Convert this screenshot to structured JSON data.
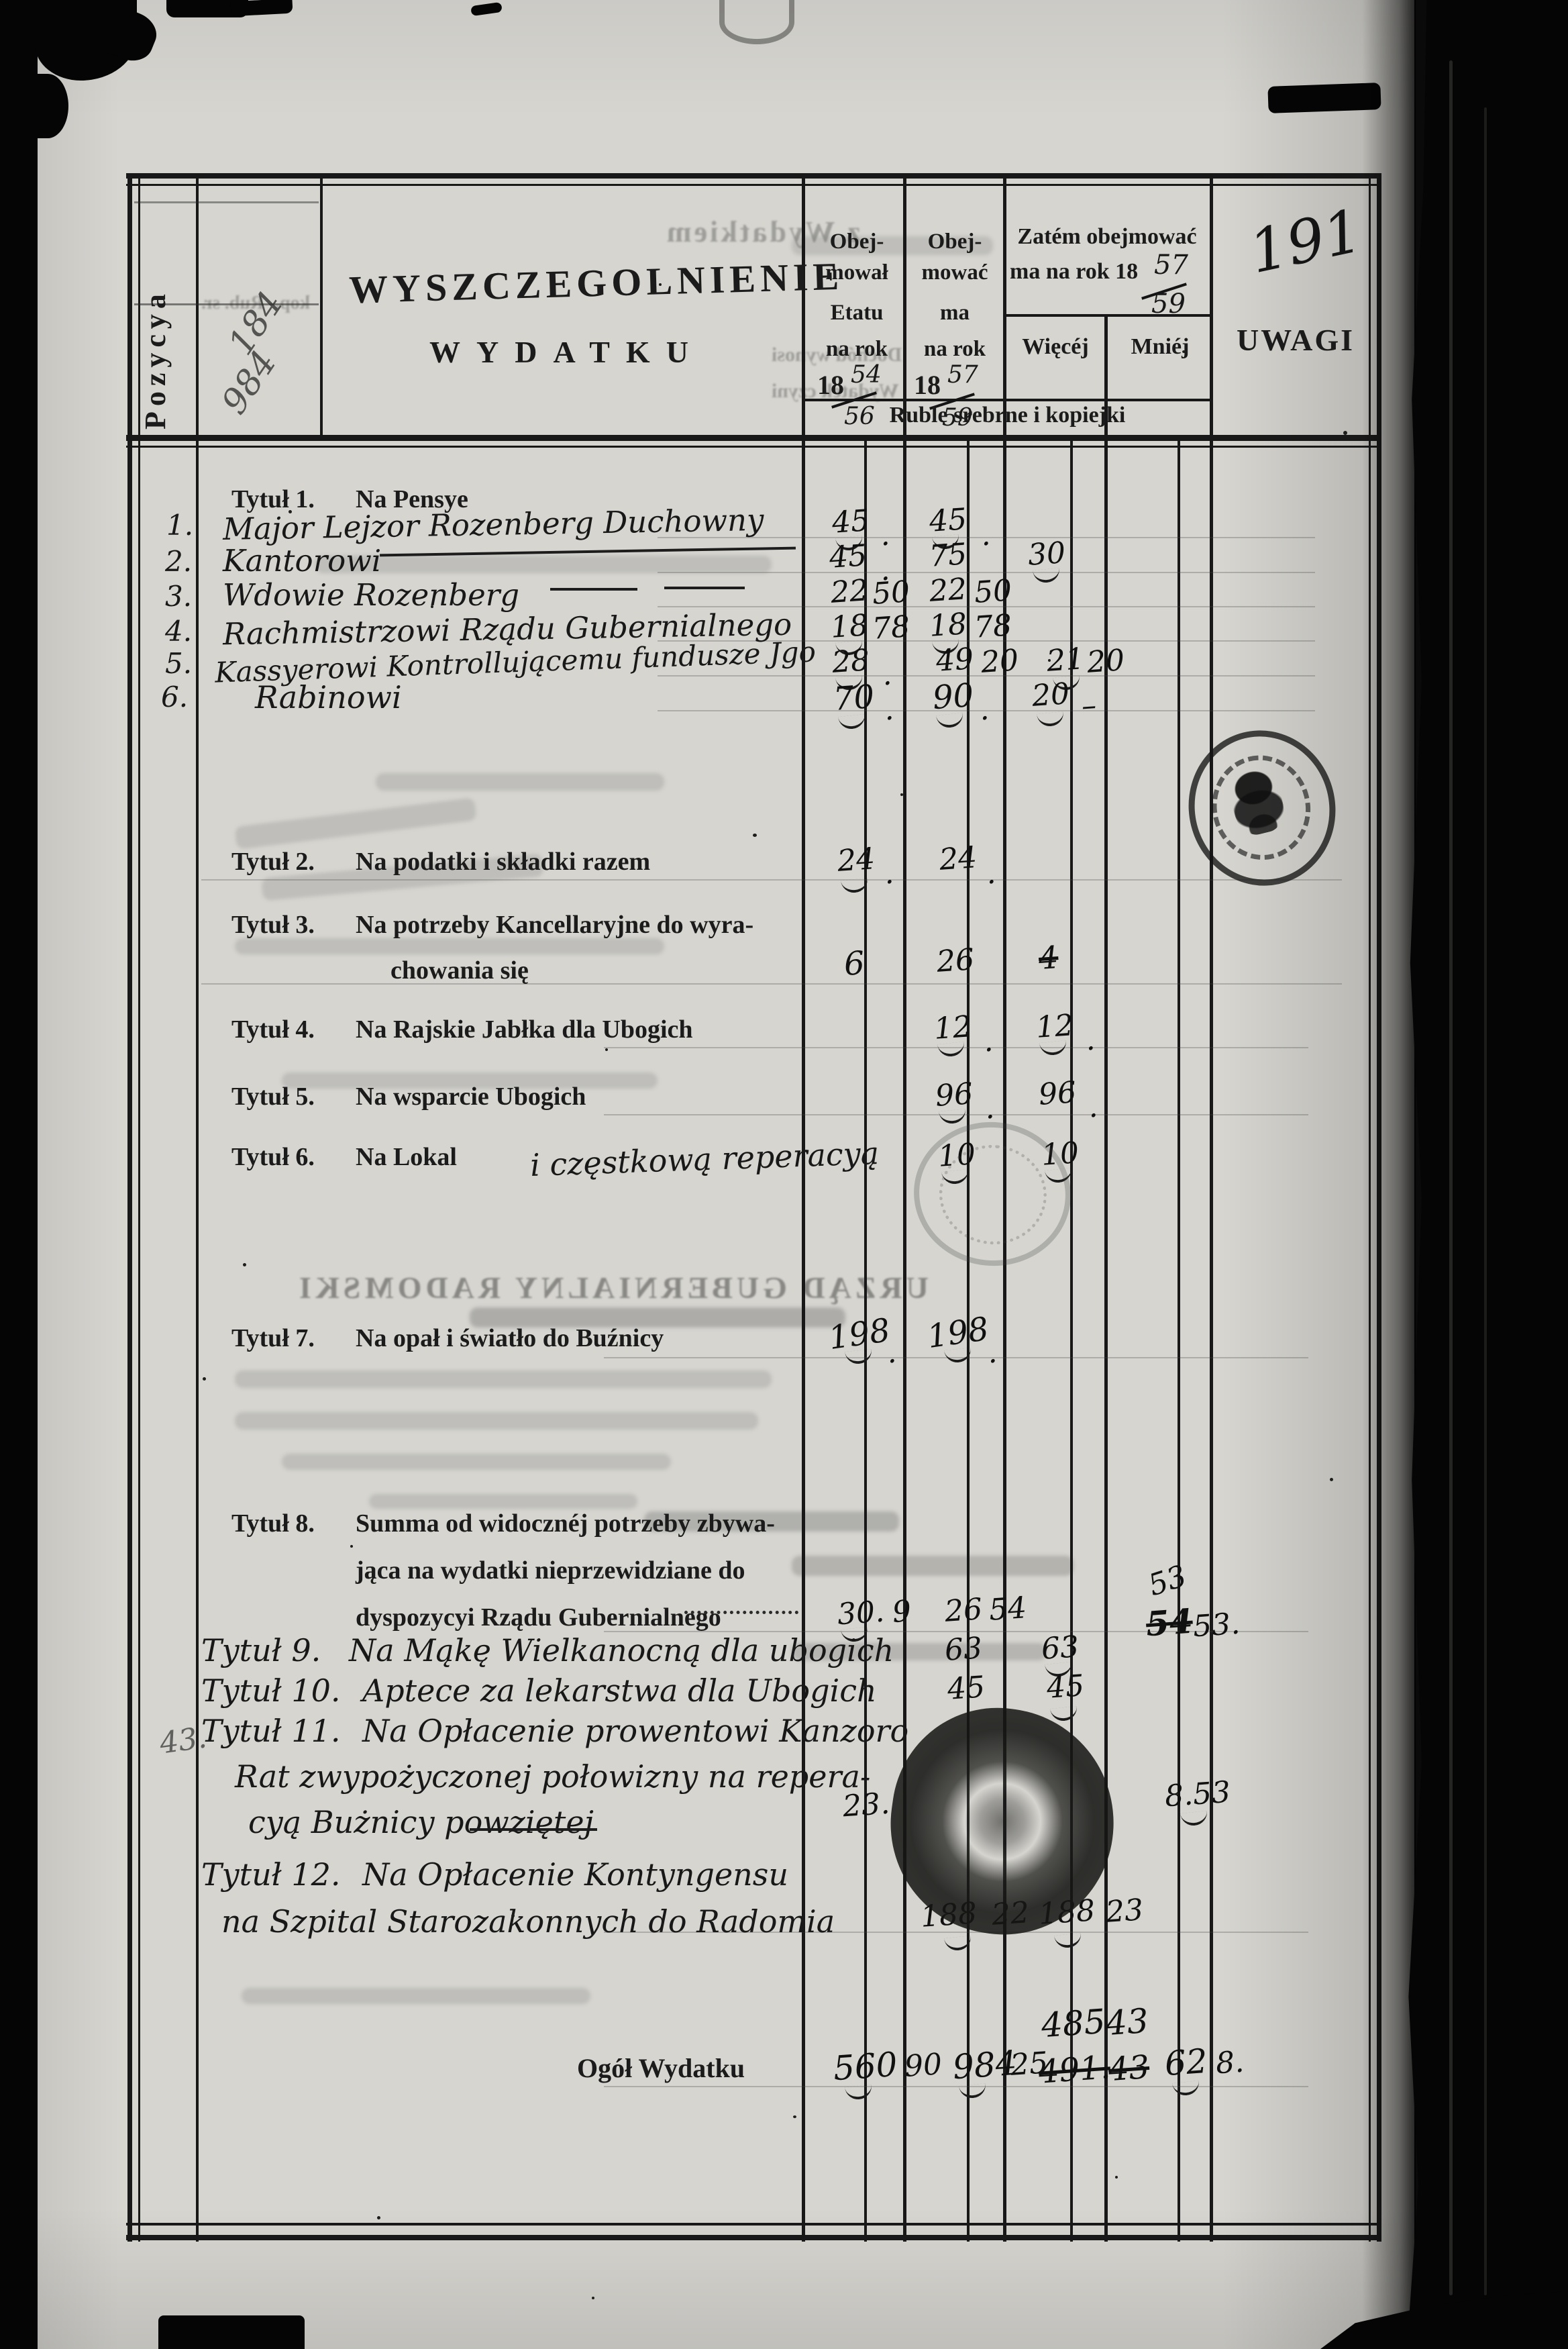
{
  "page": {
    "number": "191"
  },
  "header": {
    "pozycya": "Pozycya",
    "title_line1": "WYSZCZEGOLNIENIE",
    "title_line2": "WYDATKU",
    "col_etat": {
      "l1": "Obej-",
      "l2": "mował",
      "l3": "Etatu",
      "l4": "na rok",
      "year": "18",
      "f_top": "54",
      "f_bot": "56"
    },
    "col_ma": {
      "l1": "Obej-",
      "l2": "mować",
      "l3": "ma",
      "l4": "na rok",
      "year": "18",
      "f_top": "57",
      "f_bot": "59"
    },
    "col_zatem": {
      "l1": "Zatém obejmować",
      "l2": "ma na rok 18",
      "f_top": "57",
      "f_bot": "59",
      "wiecej": "Więcéj",
      "mniej": "Mniéj"
    },
    "uwagi": "UWAGI",
    "band": "Ruble srebrne i kopiejki"
  },
  "bleed": {
    "top": "z Wydatkiem",
    "dochod": "Dochód wynosi",
    "wydatek": "Wydatek czyni",
    "rub": "Rub. sr.",
    "kop": "kop.",
    "m1": "184",
    "m2": "984",
    "m3": "43.",
    "urzad": "URZĄD GUBERNIALNY RADOMSKI"
  },
  "body": {
    "t1_heading": "Tytuł 1.",
    "t1_text": "Na Pensye",
    "rows": [
      {
        "no": "1.",
        "label": "Major Lejzor Rozenberg Duchowny",
        "c1r": "45",
        "c1k": ".",
        "c2r": "45",
        "c2k": "."
      },
      {
        "no": "2.",
        "label": "Kantorowi",
        "c1r": "45",
        "c1k": ".",
        "c2r": "75",
        "wr": "30"
      },
      {
        "no": "3.",
        "label": "Wdowie Rozenberg",
        "c1r": "22",
        "c1k": "50",
        "c2r": "22",
        "c2k": "50"
      },
      {
        "no": "4.",
        "label": "Rachmistrzowi Rządu Gubernialnego",
        "c1r": "18",
        "c1k": "78",
        "c2r": "18",
        "c2k": "78"
      },
      {
        "no": "5.",
        "label": "Kassyerowi Kontrollującemu fundusze Jgo",
        "c1r": "28",
        "c1k": ".",
        "c2r": "49",
        "c2k": "20",
        "wr": "21",
        "wk": "20"
      },
      {
        "no": "6.",
        "label": "Rabinowi",
        "c1r": "70",
        "c1k": ".",
        "c2r": "90",
        "c2k": ".",
        "wr": "20",
        "wk": "–"
      }
    ],
    "t2": {
      "t": "Tytuł 2.",
      "label": "Na podatki i składki razem",
      "c1r": "24",
      "c1k": ".",
      "c2r": "24",
      "c2k": "."
    },
    "t3": {
      "t": "Tytuł 3.",
      "l1": "Na potrzeby Kancellaryjne do wyra-",
      "l2": "chowania się",
      "c1r": "6",
      "c2r": "26",
      "w_crossed": "4"
    },
    "t4": {
      "t": "Tytuł 4.",
      "label": "Na Rajskie Jabłka dla Ubogich",
      "c1r": "12",
      "c1k": ".",
      "c2r": "12",
      "c2k": "."
    },
    "t5": {
      "t": "Tytuł 5.",
      "label": "Na wsparcie Ubogich",
      "c1r": "96",
      "c1k": ".",
      "c2r": "96",
      "c2k": "."
    },
    "t6": {
      "t": "Tytuł 6.",
      "label": "Na Lokal",
      "hand": "i częstkową reperacyą",
      "c1r": "10",
      "c1k": ".",
      "c2r": "10",
      "c2k": "."
    },
    "t7": {
      "t": "Tytuł 7.",
      "label": "Na opał i światło do Buźnicy",
      "c1r": "198",
      "c1k": ".",
      "c2r": "198",
      "c2k": "."
    },
    "t8": {
      "t": "Tytuł 8.",
      "l1": "Summa od widocznéj potrzeby zbywa-",
      "l2": "jąca na wydatki nieprzewidziane do",
      "l3": "dyspozycyi Rządu Gubernialnego",
      "c1r": "30.",
      "c1k": "9",
      "c2r": "26",
      "c2k": "54",
      "m_new": "53",
      "m_crossed": "54",
      "mk": "53."
    },
    "t9": {
      "t": "Tytuł 9.",
      "label": "Na Mąkę Wielkanocną dla ubogich",
      "c1r": "63",
      "c2r": "63"
    },
    "t10": {
      "t": "Tytuł 10.",
      "label": "Aptece za lekarstwa dla Ubogich",
      "c1r": "45",
      "c2r": "45"
    },
    "t11": {
      "t": "Tytuł 11.",
      "l1": "Na Opłacenie prowentowi Kanzoro",
      "l2": "Rat zwypożyczonej połowizny na repera-",
      "l3": "cyą Bużnicy powziętej",
      "c1r": "23.",
      "mk": "8.53"
    },
    "t12": {
      "t": "Tytuł 12.",
      "l1": "Na Opłacenie Kontyngensu",
      "l2": "na Szpital Starozakonnych do Radomia",
      "c1r": "188",
      "c1k": "22",
      "c2r": "188",
      "c2k": "23"
    },
    "totals": {
      "label": "Ogół Wydatku",
      "c1r": "560",
      "c1k": "90",
      "c2r": "984",
      "c2k": "25",
      "w_new_r": "485",
      "w_new_k": "43",
      "w_old_r": "491.",
      "w_old_k": "43",
      "mr": "62",
      "mk": "8."
    }
  }
}
